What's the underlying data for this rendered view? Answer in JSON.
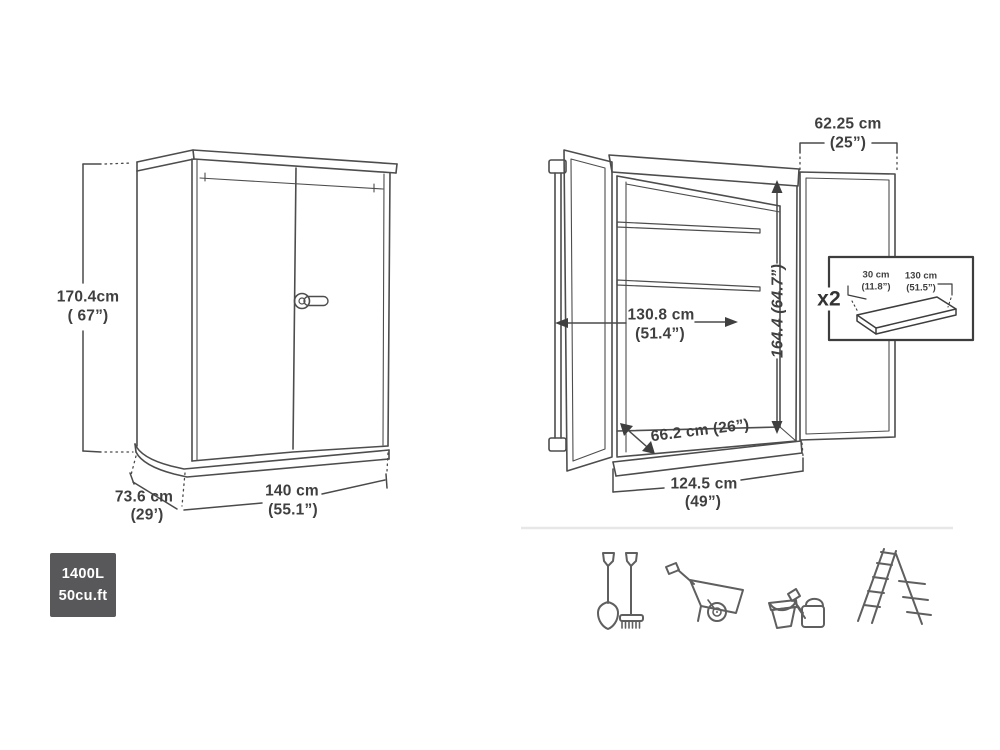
{
  "diagram": {
    "closed_view": {
      "height_cm": "170.4cm",
      "height_in": "( 67”)",
      "depth_cm": "73.6 cm",
      "depth_in": "(29’)",
      "width_cm": "140 cm",
      "width_in": "(55.1”)"
    },
    "capacity_badge": {
      "liters": "1400L",
      "cubic_feet": "50cu.ft"
    },
    "open_view": {
      "door_width_cm": "62.25 cm",
      "door_width_in": "(25”)",
      "interior_width_cm": "130.8 cm",
      "interior_width_in": "(51.4”)",
      "interior_height": "164.4 (64.7”)",
      "interior_depth": "66.2 cm (26”)",
      "opening_width_cm": "124.5 cm",
      "opening_width_in": "(49”)",
      "shelf_inset": {
        "quantity": "x2",
        "shelf_depth_cm": "30 cm",
        "shelf_depth_in": "(11.8”)",
        "shelf_width_cm": "130 cm",
        "shelf_width_in": "(51.5”)"
      }
    },
    "storage_icons": [
      "shovel-and-rake",
      "wheelbarrow",
      "bucket-and-watering-can",
      "ladder"
    ],
    "colors": {
      "line_art": "#4d4d4d",
      "dimension_text": "#3f3f3f",
      "badge_background": "#58585a",
      "badge_text": "#ffffff",
      "divider": "#e7e7e7",
      "icon_stroke": "#5f5f5f"
    }
  }
}
